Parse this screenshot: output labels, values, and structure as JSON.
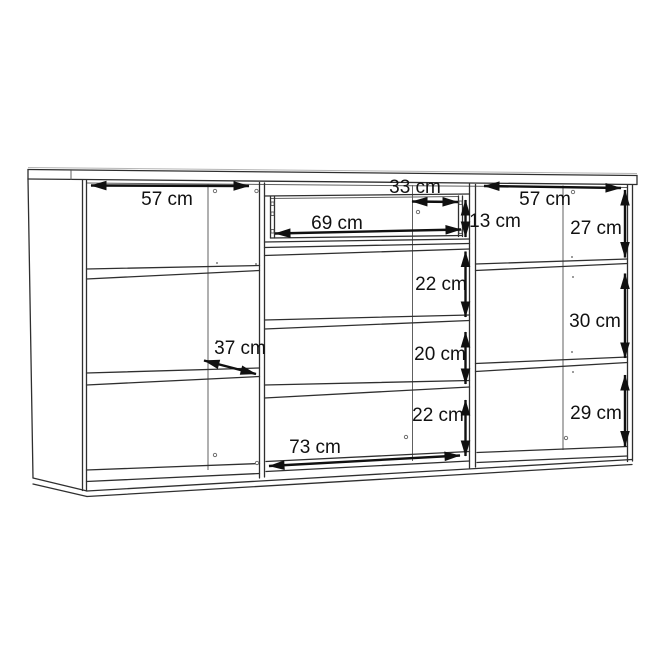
{
  "diagram": {
    "kind": "furniture-dimension-drawing",
    "unit": "cm",
    "colors": {
      "background": "#ffffff",
      "line": "#2f2f2f",
      "arrow": "#101010",
      "text": "#111111"
    },
    "dimensions": {
      "left_section_width": "57 cm",
      "drawer_depth": "33 cm",
      "drawer_opening_width": "69 cm",
      "drawer_opening_height": "13 cm",
      "right_section_width": "57 cm",
      "right_compartment_top_height": "27 cm",
      "middle_compartment_1_height": "22 cm",
      "right_compartment_middle_height": "30 cm",
      "middle_compartment_2_height": "20 cm",
      "left_shelf_depth": "37 cm",
      "middle_compartment_3_height": "22 cm",
      "right_compartment_bottom_height": "29 cm",
      "middle_section_width": "73 cm"
    }
  }
}
